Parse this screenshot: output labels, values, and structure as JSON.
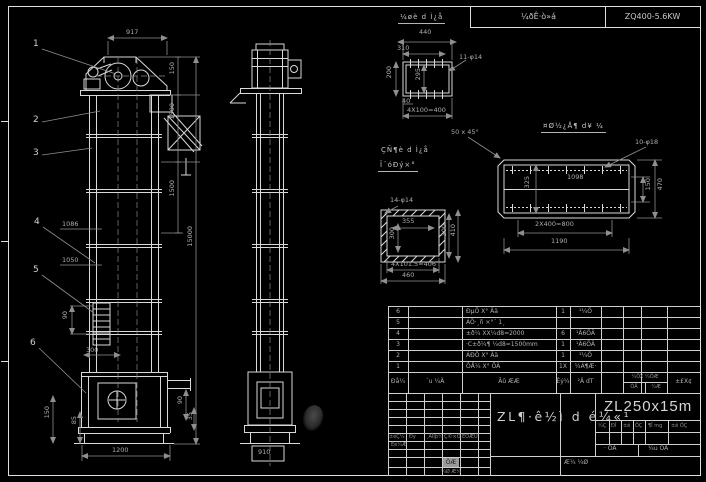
{
  "top_bar": {
    "left_cell": "¼ðÊ·ò»á",
    "right_cell": "ZQ400-5.6KW"
  },
  "front_view": {
    "balloons": [
      "1",
      "2",
      "3",
      "4",
      "5",
      "6"
    ],
    "dims": {
      "top_917": "917",
      "r_150": "150",
      "r_1500a": "1500",
      "r_1500b": "1500",
      "r_15000": "15000",
      "l_1086": "1086",
      "l_1050": "1050",
      "l_90": "90",
      "l_300": "300",
      "bl_150": "150",
      "bl_85": "85",
      "br_90": "90",
      "br_35": "35",
      "bottom_1200": "1200"
    }
  },
  "side_view": {
    "dims": {
      "bottom_910": "910"
    }
  },
  "detail_top_right": {
    "title": "¼øè d Ì¿å",
    "dims": {
      "w_440": "440",
      "w_310": "310",
      "holes": "11-φ14",
      "v_295": "295",
      "v_200": "200",
      "s_40": "40",
      "b_400": "4X100=400"
    }
  },
  "detail_flange": {
    "title": "¤Ø½¿Å¶ d¥ ¼",
    "note": "50 x 45°",
    "dims": {
      "holes": "10-φ18",
      "c_1098": "1098",
      "v_325": "325",
      "r_150": "150",
      "r_470": "470",
      "b_800": "2X400=800",
      "b_1190": "1190"
    }
  },
  "detail_base_plate": {
    "title_line1": "ÇÑ¶è d Ì¿å",
    "title_line2": "Î¨óÐý×°",
    "dims": {
      "holes": "14-φ14",
      "t_355": "355",
      "l_300": "300",
      "r_300": "300",
      "r_410": "410",
      "b_406": "4X101.5=406",
      "b_460": "460"
    }
  },
  "bom": {
    "rows": [
      {
        "no": "6",
        "code": "",
        "name": "ÐµÖ X° Ää",
        "qty": "1",
        "mat": "¹¼Ö"
      },
      {
        "no": "5",
        "code": "",
        "name": "ÁÖ·¸ñ ×°´ 1¸",
        "qty": "",
        "mat": ""
      },
      {
        "no": "4",
        "code": "",
        "name": "±ð¼ XX¼d8=2000",
        "qty": "6",
        "mat": "¹Ä6ÖÂ"
      },
      {
        "no": "3",
        "code": "",
        "name": "·C±ð¼¶ ¼d8=1500mm",
        "qty": "1",
        "mat": "¹Ä6ÖÂ"
      },
      {
        "no": "2",
        "code": "",
        "name": "ÁÐÖ X° Ää",
        "qty": "1",
        "mat": "¹¼Ö"
      },
      {
        "no": "1",
        "code": "",
        "name": "ÔÅ¼ X° ÕÄ",
        "qty": "1X",
        "mat": "¼Á¶Æ·"
      }
    ],
    "header": {
      "no": "Ðå¼",
      "code": "´u ¼Ä",
      "name": "Ãû ÆÆ",
      "qty": "Êý¼",
      "mat": "²Ä dT",
      "weight_top": "¼ÖX ¼ÖÆ",
      "weight_b1": "ÕÄ",
      "weight_b2": "¼Æ",
      "note": "±£X¢"
    }
  },
  "title_block": {
    "model": "ZL250x15m",
    "drawing_name": "ZL¶·ê½ì d é¼«¹",
    "rev_cols": [
      "±êÇ¼",
      "Ðý",
      "¸ÄÎļþ¼",
      "Ç©×Ö",
      "ÈÕÆÚ"
    ],
    "designer": "Éè¼Æ",
    "stamp": "ÖÆ",
    "note1": "¼Ø Æ¼",
    "note2": "Æ¼ ¼Ø",
    "mark_cells": [
      "¼Ç",
      "ÐÎ",
      "±ê",
      "ÖÇ",
      "¶Î mg",
      "±ê ÖÇ"
    ],
    "scale_label": "· ÕÄ",
    "sheet_label": "¼u ÕÄ"
  }
}
